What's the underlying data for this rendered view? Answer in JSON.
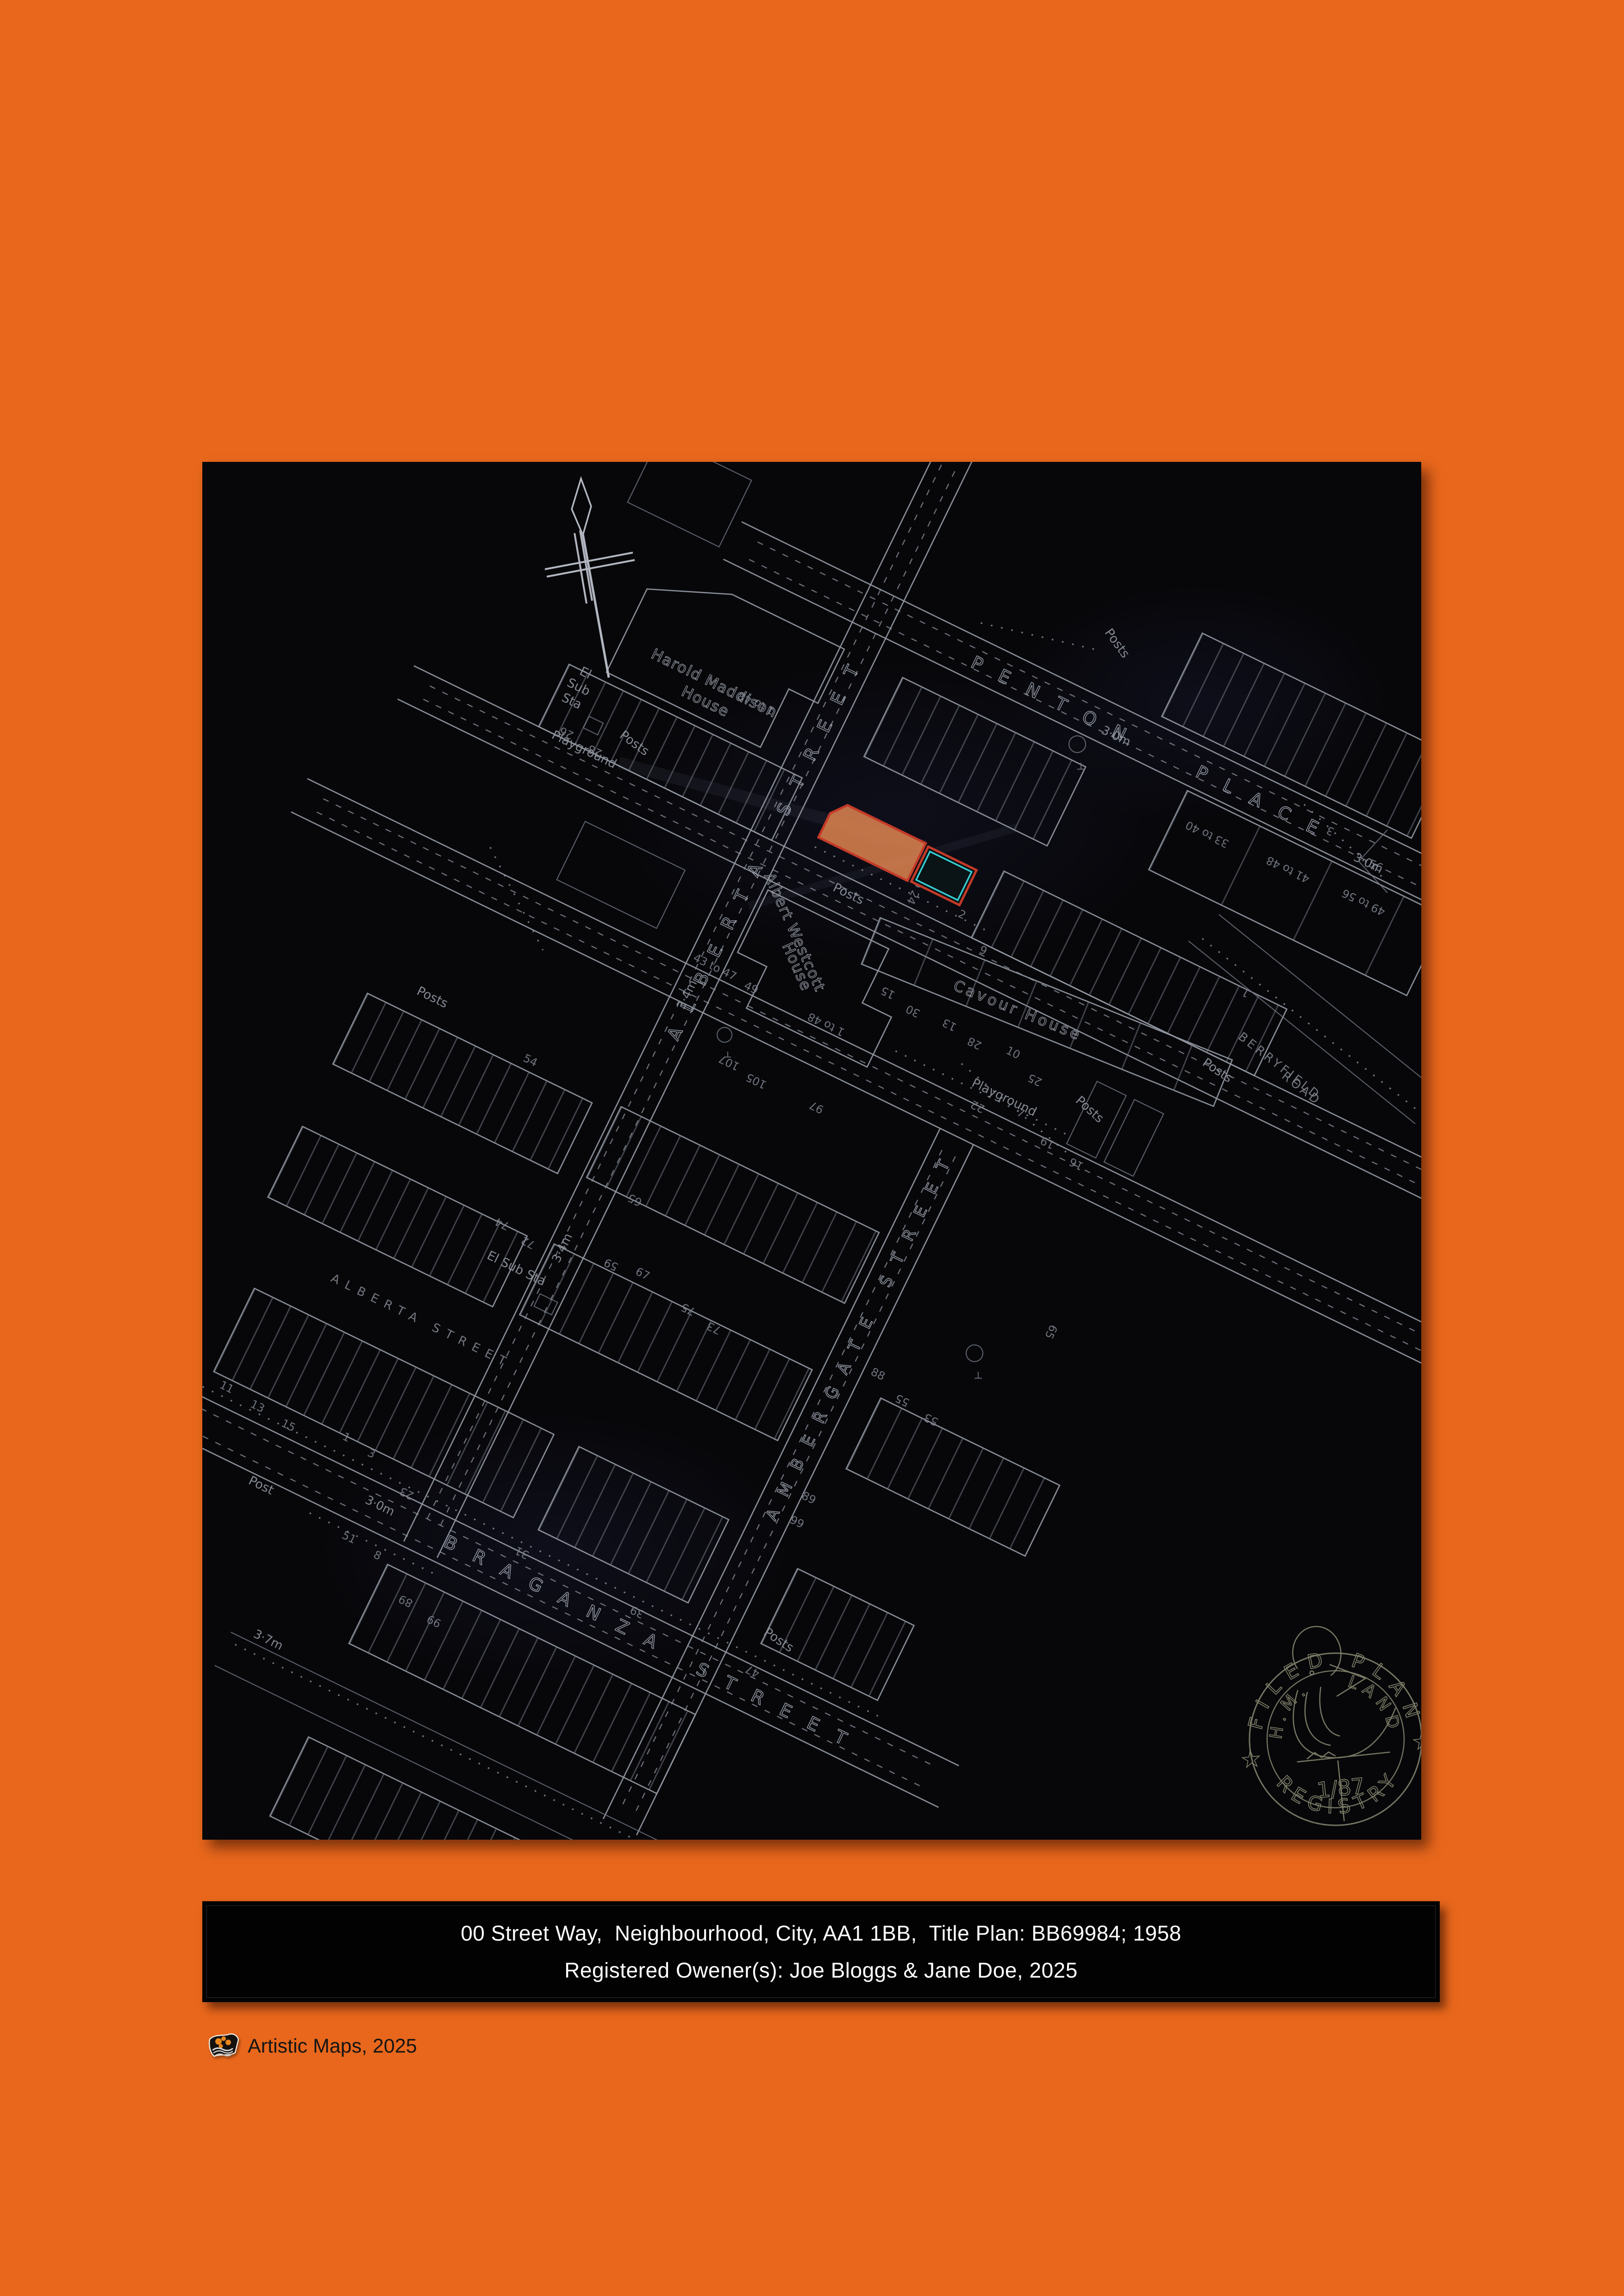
{
  "page": {
    "background_color": "#E8671C",
    "panel_color": "#060609"
  },
  "caption": {
    "line1": "00 Street Way,  Neighbourhood, City, AA1 1BB,  Title Plan: BB69984; 1958",
    "line2": "Registered Owener(s): Joe Bloggs & Jane Doe, 2025"
  },
  "footer": {
    "credit": "Artistic Maps, 2025"
  },
  "map": {
    "streets": {
      "penton": "PENTON",
      "place": "PLACE",
      "alberta": "ALBERTA",
      "street": "STREET",
      "alberta_street_sm": "ALBERTA   STREET",
      "ambergate_street": "AMBERGATE  STREET",
      "braganza": "BRAGANZA",
      "braganza_street_word": "STREET",
      "berryfield": "BERRYFIELD",
      "road": "ROAD"
    },
    "buildings": {
      "harold_maddison_1": "Harold Maddison",
      "harold_maddison_2": "House",
      "albert_westcott_1": "Albert Westcott",
      "albert_westcott_2": "House",
      "cavour": "Cavour House"
    },
    "annotations": {
      "posts": "Posts",
      "post": "Post",
      "playground": "Playground",
      "el": "El",
      "sub": "Sub",
      "sta": "Sta",
      "el_sub_sta": "El Sub Sta",
      "one_to_48": "1 to 48",
      "m30": "3·0m",
      "m34": "3·4m",
      "m37": "3·7m"
    },
    "house_numbers": [
      "2",
      "6",
      "8 to 24",
      "26",
      "28",
      "1 to 48",
      "33 to 40",
      "41 to 48",
      "49 to 56",
      "15",
      "30",
      "13",
      "28",
      "10",
      "25",
      "22",
      "7",
      "19",
      "16",
      "107",
      "105",
      "97",
      "75",
      "73",
      "74",
      "72",
      "54",
      "65",
      "59",
      "67",
      "55",
      "53",
      "88",
      "89",
      "99",
      "23",
      "31",
      "39",
      "47",
      "11",
      "13",
      "15",
      "1",
      "3",
      "56",
      "65",
      "43 to 47",
      "49",
      "51",
      "8",
      "10"
    ],
    "highlight_colors": {
      "outline": "#C43A28",
      "fill": "#D9814E",
      "inner": "#37CFD4"
    },
    "stamp": {
      "filed_plan": "FILED PLAN",
      "hm": "H.M.",
      "land": "LAND",
      "registry": "REGISTRY",
      "number": "1/87",
      "star": "★"
    }
  }
}
